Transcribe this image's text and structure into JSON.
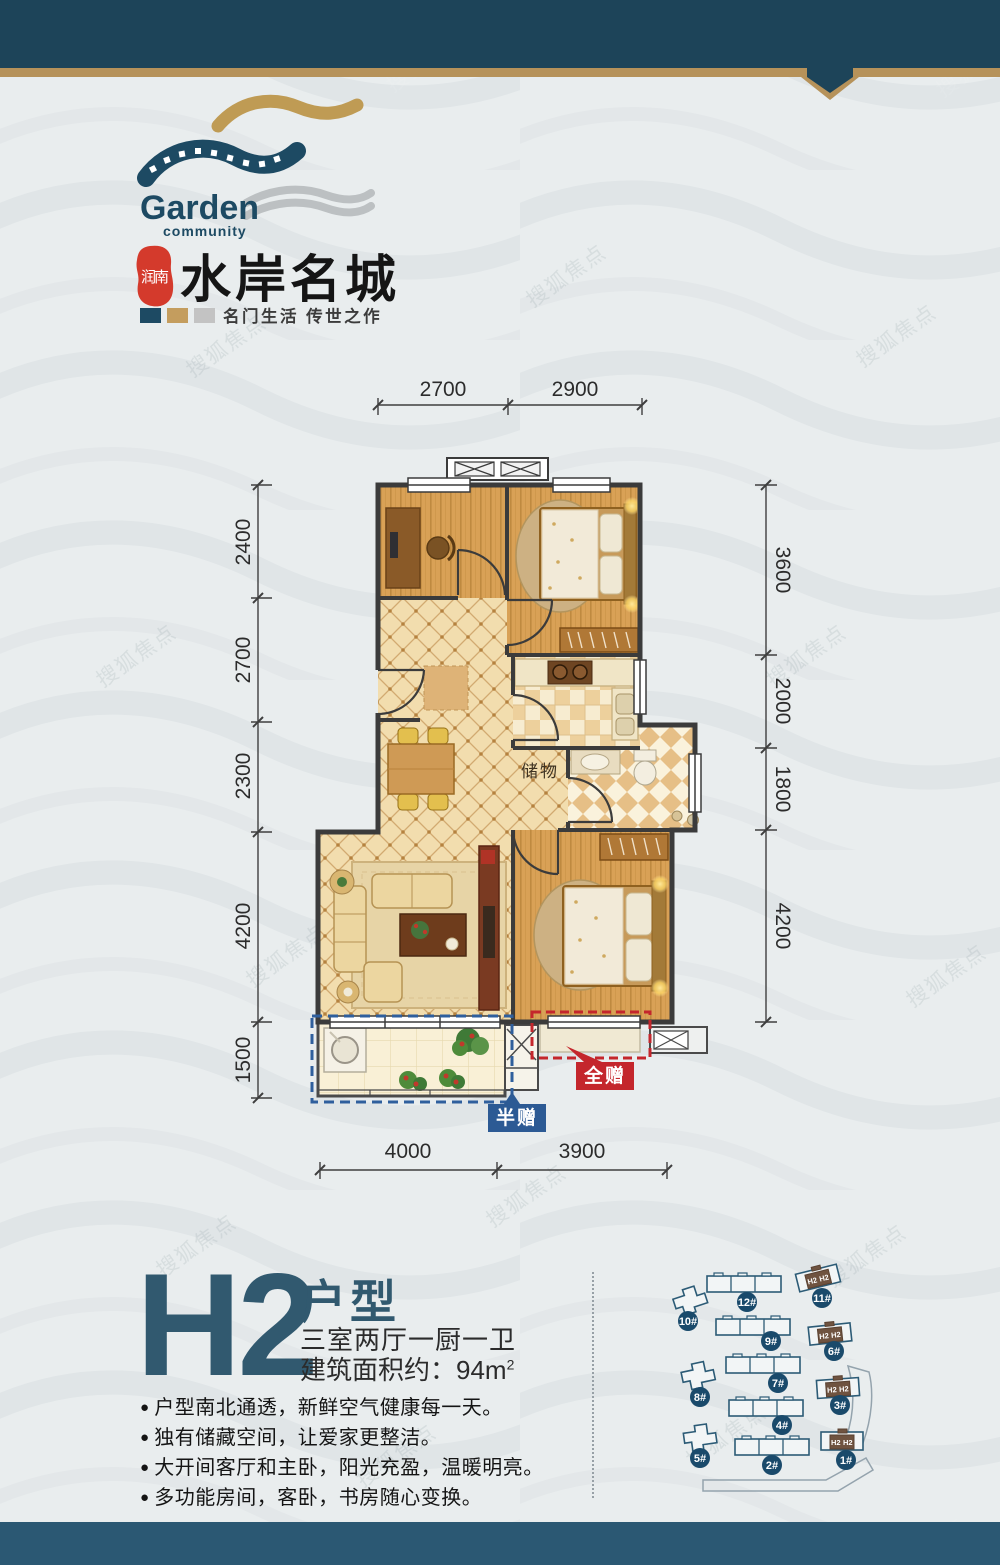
{
  "watermark": {
    "text": "搜狐焦点"
  },
  "header": {
    "brand_en": "Garden",
    "brand_en_sub": "community",
    "seal_text": "润南",
    "brand_cn": "水岸名城",
    "tagline": "名门生活  传世之作"
  },
  "plan": {
    "dims_top": [
      "2700",
      "2900"
    ],
    "dims_left": [
      "2400",
      "2700",
      "2300",
      "4200",
      "1500"
    ],
    "dims_right": [
      "3600",
      "2000",
      "1800",
      "4200"
    ],
    "dims_bottom": [
      "4000",
      "3900"
    ],
    "labels": {
      "storage": "储物",
      "full_gift": "全赠",
      "half_gift": "半赠"
    }
  },
  "info": {
    "unit_code": "H2",
    "unit_type_label": "户型",
    "layout_desc": "三室两厅一厨一卫",
    "area_text": "建筑面积约：94m",
    "area_sup": "2",
    "features": [
      "户型南北通透，新鲜空气健康每一天。",
      "独有储藏空间，让爱家更整洁。",
      "大开间客厅和主卧，阳光充盈，温暖明亮。",
      "多功能房间，客卧，书房随心变换。"
    ]
  },
  "siteplan": {
    "h2_tag": "H2",
    "buildings": [
      {
        "label": "10#"
      },
      {
        "label": "12#"
      },
      {
        "label": "11#"
      },
      {
        "label": "9#"
      },
      {
        "label": "6#"
      },
      {
        "label": "8#"
      },
      {
        "label": "7#"
      },
      {
        "label": "3#"
      },
      {
        "label": "4#"
      },
      {
        "label": "5#"
      },
      {
        "label": "2#"
      },
      {
        "label": "1#"
      }
    ]
  }
}
